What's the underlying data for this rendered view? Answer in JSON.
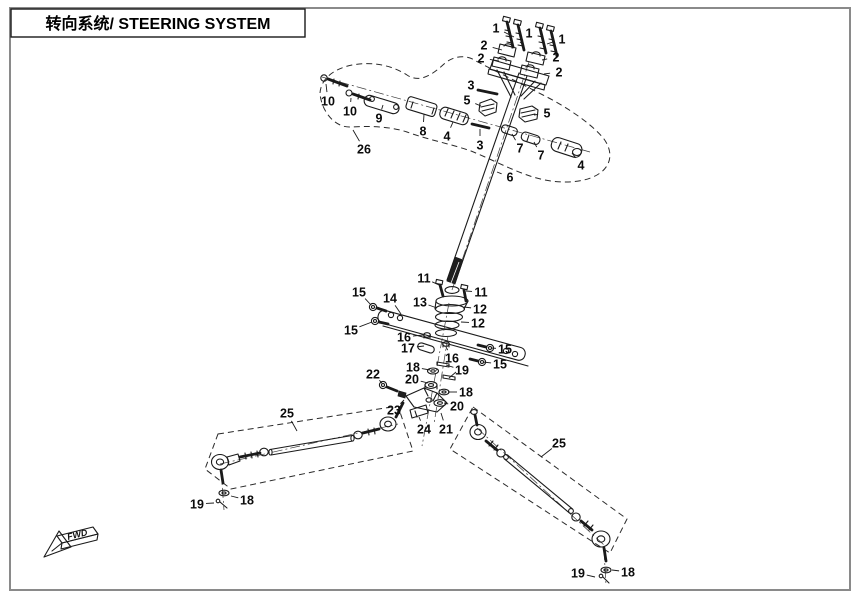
{
  "title": {
    "text": "转向系统/ STEERING SYSTEM"
  },
  "fwd": {
    "label": "FWD"
  },
  "colors": {
    "line": "#1a1a1a",
    "page_border": "#8a8a8a",
    "background": "#ffffff",
    "label": "#0b0b0b"
  },
  "diagram": {
    "description": "Exploded view parts diagram of ATV steering system with numbered callouts",
    "callouts": [
      {
        "label": "1",
        "x": 496,
        "y": 28,
        "lx": 514,
        "ly": 37
      },
      {
        "label": "1",
        "x": 529,
        "y": 33,
        "lx": 520,
        "ly": 43
      },
      {
        "label": "1",
        "x": 562,
        "y": 39,
        "lx": 547,
        "ly": 44
      },
      {
        "label": "2",
        "x": 484,
        "y": 45,
        "lx": 502,
        "ly": 50
      },
      {
        "label": "2",
        "x": 481,
        "y": 58,
        "lx": 499,
        "ly": 61
      },
      {
        "label": "2",
        "x": 556,
        "y": 57,
        "lx": 542,
        "ly": 60
      },
      {
        "label": "2",
        "x": 559,
        "y": 72,
        "lx": 544,
        "ly": 74
      },
      {
        "label": "3",
        "x": 471,
        "y": 85,
        "lx": 479,
        "ly": 90
      },
      {
        "label": "10",
        "x": 328,
        "y": 101,
        "lx": 326,
        "ly": 84
      },
      {
        "label": "10",
        "x": 350,
        "y": 111,
        "lx": 351,
        "ly": 98
      },
      {
        "label": "9",
        "x": 379,
        "y": 118,
        "lx": 383,
        "ly": 105
      },
      {
        "label": "8",
        "x": 423,
        "y": 131,
        "lx": 424,
        "ly": 114
      },
      {
        "label": "4",
        "x": 447,
        "y": 136,
        "lx": 453,
        "ly": 122
      },
      {
        "label": "26",
        "x": 364,
        "y": 149,
        "lx": 353,
        "ly": 130
      },
      {
        "label": "5",
        "x": 467,
        "y": 100,
        "lx": 481,
        "ly": 106
      },
      {
        "label": "5",
        "x": 547,
        "y": 113,
        "lx": 534,
        "ly": 115
      },
      {
        "label": "3",
        "x": 480,
        "y": 145,
        "lx": 480,
        "ly": 129
      },
      {
        "label": "7",
        "x": 520,
        "y": 148,
        "lx": 512,
        "ly": 134
      },
      {
        "label": "7",
        "x": 541,
        "y": 155,
        "lx": 534,
        "ly": 142
      },
      {
        "label": "4",
        "x": 581,
        "y": 165,
        "lx": 572,
        "ly": 153
      },
      {
        "label": "6",
        "x": 510,
        "y": 177,
        "lx": 497,
        "ly": 172
      },
      {
        "label": "11",
        "x": 424,
        "y": 278,
        "lx": 439,
        "ly": 285
      },
      {
        "label": "11",
        "x": 481,
        "y": 292,
        "lx": 466,
        "ly": 291
      },
      {
        "label": "15",
        "x": 359,
        "y": 292,
        "lx": 371,
        "ly": 305
      },
      {
        "label": "14",
        "x": 390,
        "y": 298,
        "lx": 401,
        "ly": 314
      },
      {
        "label": "13",
        "x": 420,
        "y": 302,
        "lx": 437,
        "ly": 308
      },
      {
        "label": "12",
        "x": 480,
        "y": 309,
        "lx": 464,
        "ly": 307
      },
      {
        "label": "12",
        "x": 478,
        "y": 323,
        "lx": 461,
        "ly": 322
      },
      {
        "label": "15",
        "x": 351,
        "y": 330,
        "lx": 372,
        "ly": 322
      },
      {
        "label": "16",
        "x": 404,
        "y": 337,
        "lx": 423,
        "ly": 335
      },
      {
        "label": "17",
        "x": 408,
        "y": 348,
        "lx": 424,
        "ly": 346
      },
      {
        "label": "16",
        "x": 452,
        "y": 358,
        "lx": 446,
        "ly": 347
      },
      {
        "label": "15",
        "x": 505,
        "y": 349,
        "lx": 491,
        "ly": 348
      },
      {
        "label": "15",
        "x": 500,
        "y": 364,
        "lx": 483,
        "ly": 362
      },
      {
        "label": "18",
        "x": 413,
        "y": 367,
        "lx": 430,
        "ly": 370
      },
      {
        "label": "19",
        "x": 462,
        "y": 370,
        "lx": 446,
        "ly": 365
      },
      {
        "label": "20",
        "x": 412,
        "y": 379,
        "lx": 428,
        "ly": 383
      },
      {
        "label": "22",
        "x": 373,
        "y": 374,
        "lx": 382,
        "ly": 383
      },
      {
        "label": "18",
        "x": 466,
        "y": 392,
        "lx": 448,
        "ly": 392
      },
      {
        "label": "20",
        "x": 457,
        "y": 406,
        "lx": 444,
        "ly": 403
      },
      {
        "label": "23",
        "x": 394,
        "y": 410,
        "lx": 404,
        "ly": 400
      },
      {
        "label": "24",
        "x": 424,
        "y": 429,
        "lx": 419,
        "ly": 417
      },
      {
        "label": "21",
        "x": 446,
        "y": 429,
        "lx": 441,
        "ly": 413
      },
      {
        "label": "25",
        "x": 287,
        "y": 413,
        "lx": 297,
        "ly": 431
      },
      {
        "label": "25",
        "x": 559,
        "y": 443,
        "lx": 541,
        "ly": 457
      },
      {
        "label": "19",
        "x": 197,
        "y": 504,
        "lx": 214,
        "ly": 503
      },
      {
        "label": "18",
        "x": 247,
        "y": 500,
        "lx": 231,
        "ly": 496
      },
      {
        "label": "19",
        "x": 578,
        "y": 573,
        "lx": 595,
        "ly": 577
      },
      {
        "label": "18",
        "x": 628,
        "y": 572,
        "lx": 612,
        "ly": 570
      }
    ],
    "extra_leaders": [
      {
        "x1": 456,
        "y1": 372,
        "x2": 449,
        "y2": 378
      }
    ]
  }
}
